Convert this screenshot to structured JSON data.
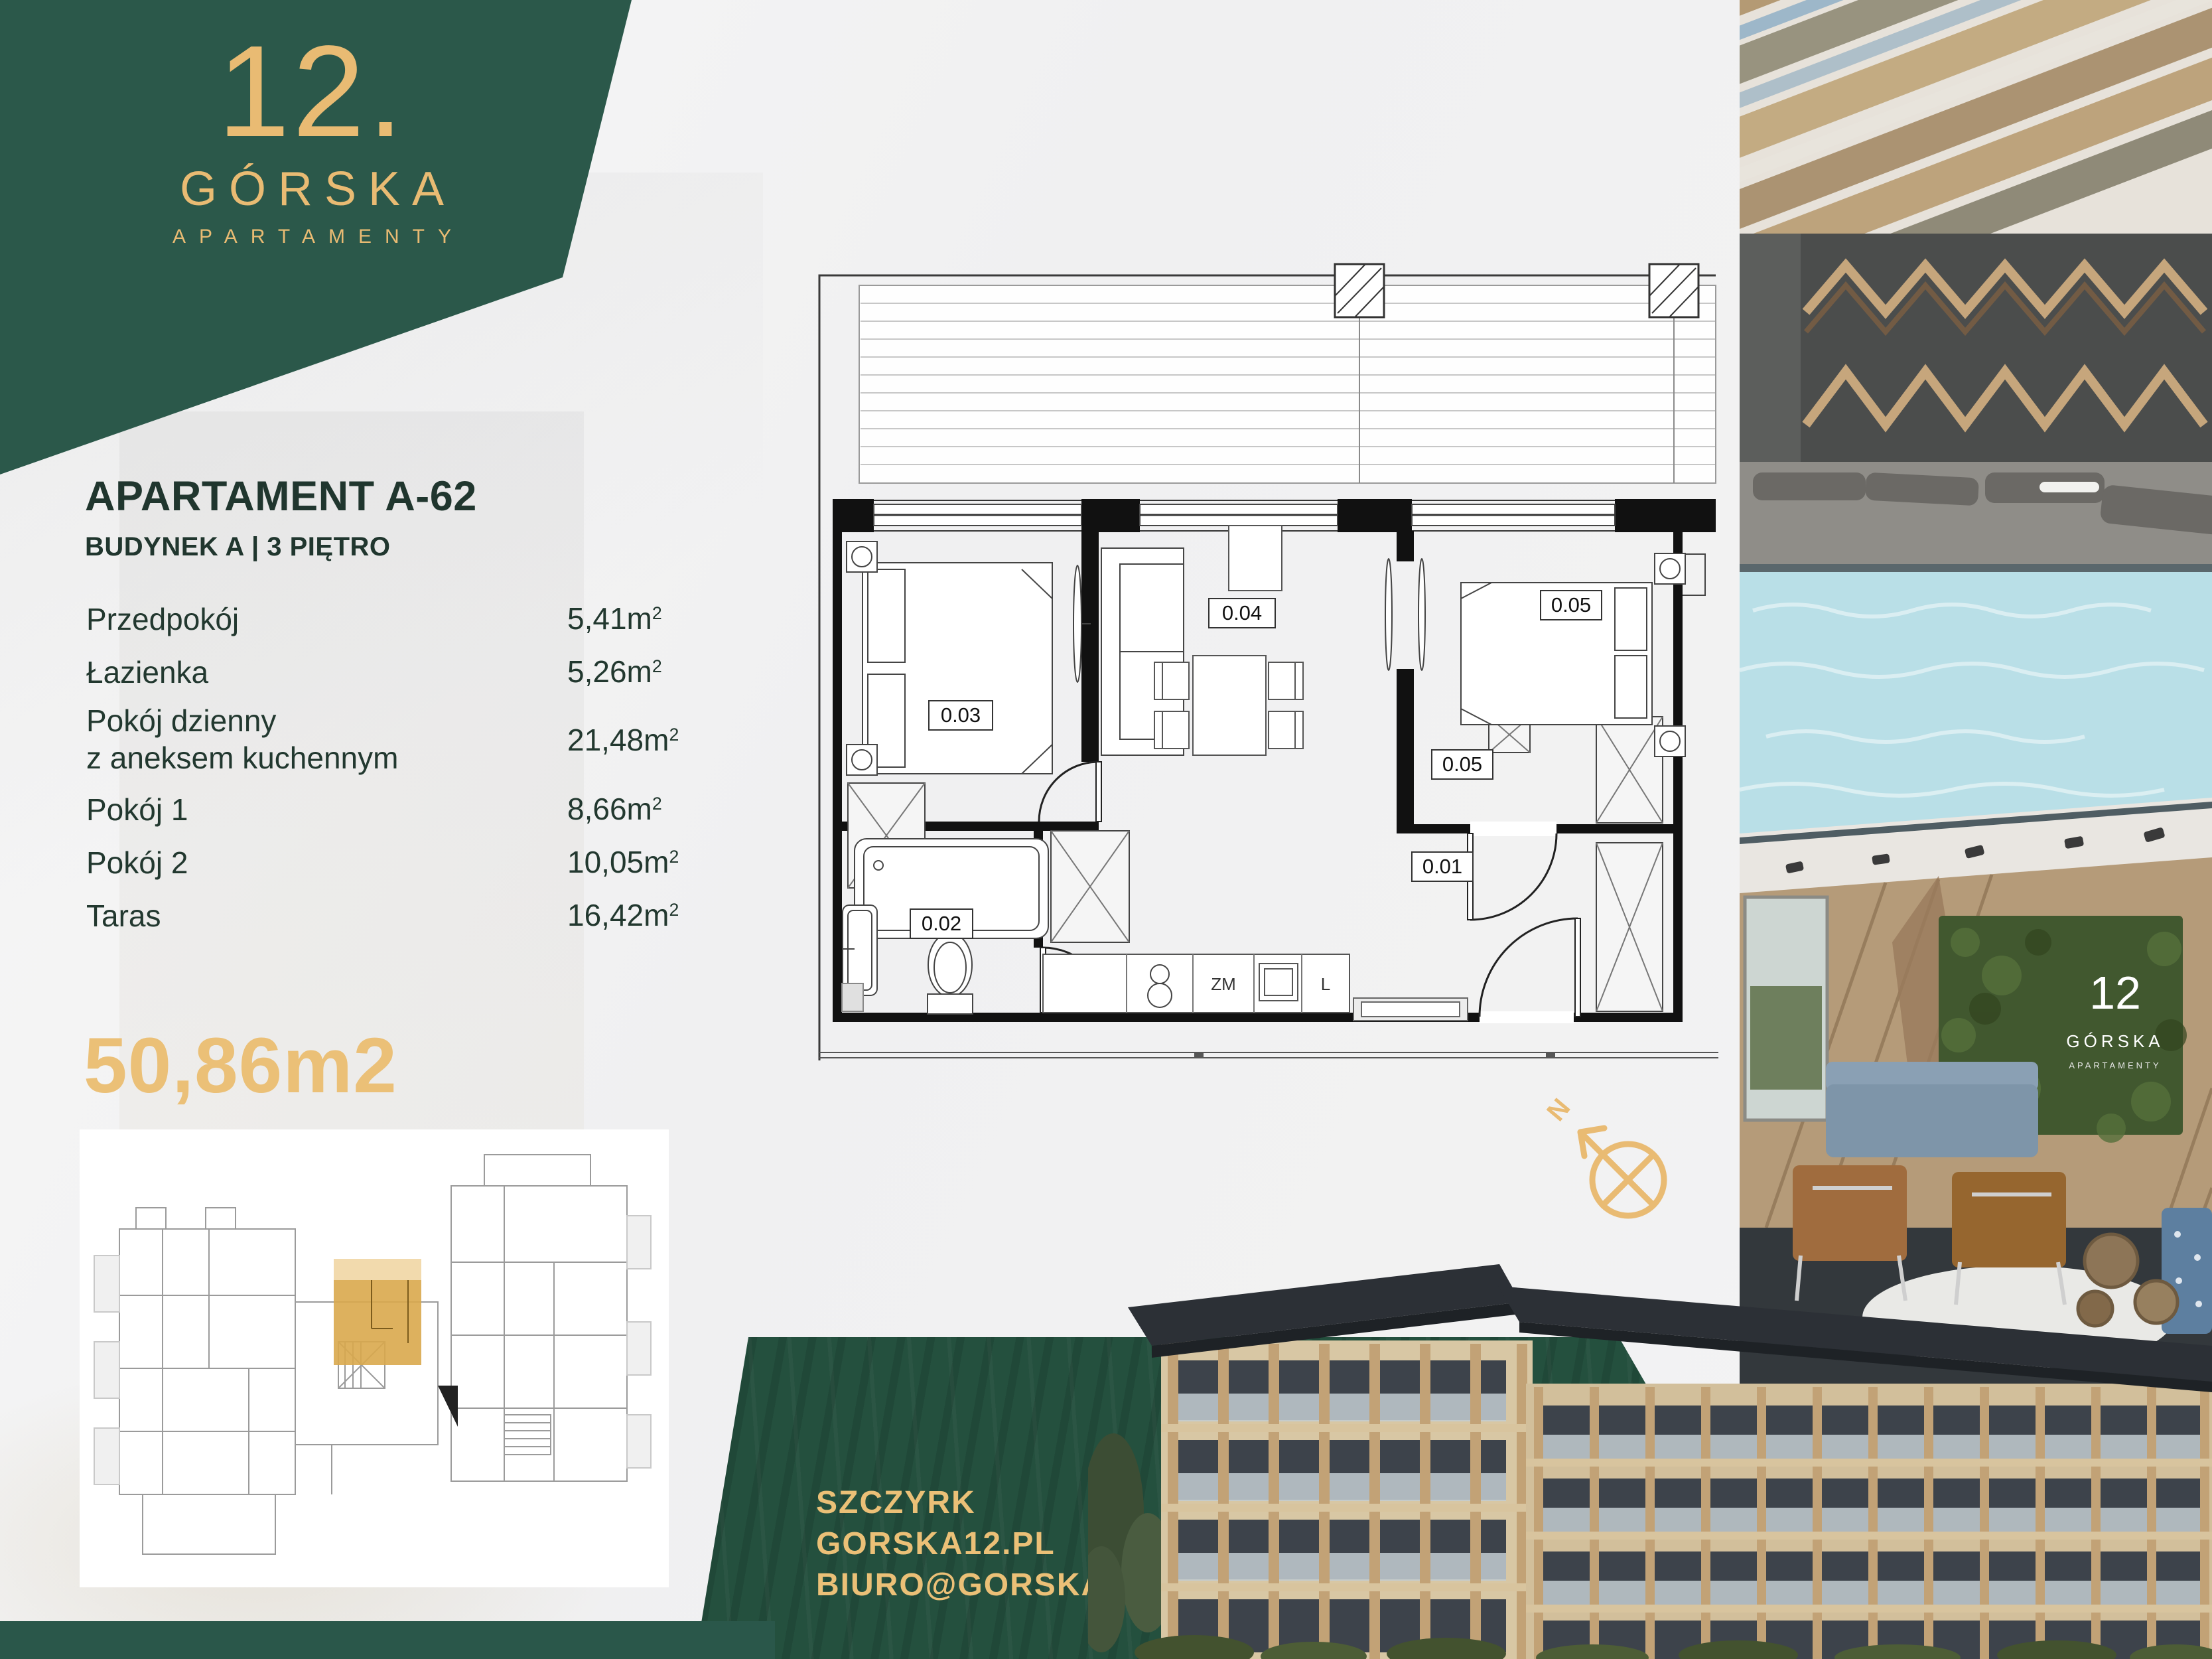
{
  "brand": {
    "number": "12.",
    "name": "GÓRSKA",
    "tagline": "APARTAMENTY"
  },
  "listing": {
    "title": "APARTAMENT A-62",
    "subtitle": "BUDYNEK A | 3 PIĘTRO",
    "rooms": [
      {
        "label": "Przedpokój",
        "label2": "",
        "value": "5,41",
        "unit": "m",
        "sup": "2"
      },
      {
        "label": "Łazienka",
        "label2": "",
        "value": "5,26",
        "unit": "m",
        "sup": "2"
      },
      {
        "label": "Pokój dzienny",
        "label2": "z aneksem kuchennym",
        "value": "21,48",
        "unit": "m",
        "sup": "2"
      },
      {
        "label": "Pokój 1",
        "label2": "",
        "value": "8,66",
        "unit": "m",
        "sup": "2"
      },
      {
        "label": "Pokój 2",
        "label2": "",
        "value": "10,05",
        "unit": "m",
        "sup": "2"
      },
      {
        "label": "Taras",
        "label2": "",
        "value": "16,42",
        "unit": "m",
        "sup": "2"
      }
    ],
    "total_area": "50,86m2"
  },
  "floorplan": {
    "labels": {
      "l01": "0.01",
      "l02": "0.02",
      "l03": "0.03",
      "l04": "0.04",
      "l05a": "0.05",
      "l05b": "0.05"
    },
    "kitchen": {
      "zm": "ZM",
      "l": "L"
    },
    "compass": "N"
  },
  "lobby_logo": {
    "number": "12",
    "name": "GÓRSKA",
    "tagline": "APARTAMENTY"
  },
  "contact": {
    "city": "SZCZYRK",
    "website": "GORSKA12.PL",
    "email": "BIURO@GORSKA12.PL"
  },
  "colors": {
    "green": "#2B584A",
    "green_dark": "#24503E",
    "gold": "#E9BB73",
    "text": "#20362E"
  }
}
